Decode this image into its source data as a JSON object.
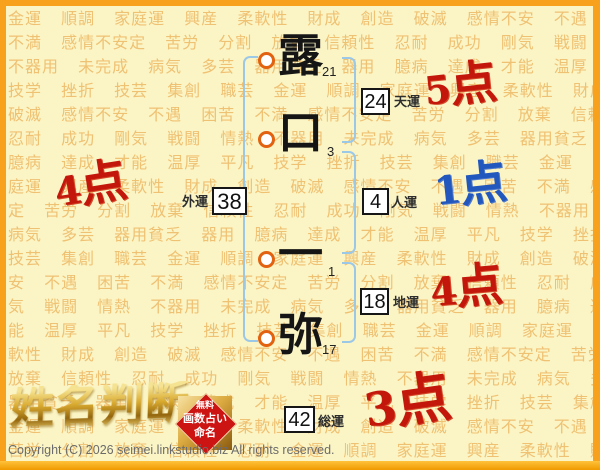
{
  "background": {
    "rows": [
      "金運 順調 家庭運 興産 柔軟性 財成 創造 破滅 感情不安 不遇 困苦",
      "不満 感情不安定 苦労 分割 放棄 信頼性 忍耐 成功 剛気 戦闘 情熱",
      "不器用 未完成 病気 多芸 器用貧乏 器用 臆病 達成 才能 温厚 平凡",
      "技学 挫折 技芸 集創 職芸 金運 順調 家庭運 興産 柔軟性 財成 創造",
      "破滅 感情不安 不遇 困苦 不満 感情不安定 苦労 分割 放棄 信頼性",
      "忍耐 成功 剛気 戦闘 情熱 不器用 未完成 病気 多芸 器用貧乏 器用",
      "臆病 達成 才能 温厚 平凡 技学 挫折 技芸 集創 職芸 金運",
      "庭運 興産 柔軟性 財成 創造 破滅 感情不安 不遇 困苦 不満 感情",
      "定 苦労 分割 放棄 信頼性 忍耐 成功 剛気 戦闘 情熱 不器用",
      "病気 多芸 器用貧乏 器用 臆病 達成 才能 温厚 平凡 技学 挫折",
      "技芸 集創 職芸 金運 順調 家庭運 興産 柔軟性 財成 創造 破滅",
      "安 不遇 困苦 不満 感情不安定 苦労 分割 放棄 信頼性 忍耐 成功",
      "気 戦闘 情熱 不器用 未完成 病気 多芸 器用貧乏 器用 臆病 達成",
      "能 温厚 平凡 技学 挫折 技芸 集創 職芸 金運 順調 家庭運",
      "軟性 財成 創造 破滅 感情不安 不遇 困苦 不満 感情不安定 苦労",
      "放棄 信頼性 忍耐 成功 剛気 戦闘 情熱 不器用 未完成 病気 多芸",
      "器用貧乏 器用 臆病 達成 才能 温厚 平凡 技学 挫折 技芸 集創",
      "金運 順調 家庭運 画数 柔軟性 財成 創造 破滅 感情不安 不遇",
      "苦労 分割 放棄 信頼性 忍耐 金運 順調 家庭運 興産 柔軟性 財成"
    ]
  },
  "name": {
    "characters": [
      {
        "char": "露",
        "strokes": "21"
      },
      {
        "char": "口",
        "strokes": "3"
      },
      {
        "char": "一",
        "strokes": "1"
      },
      {
        "char": "弥",
        "strokes": "17"
      }
    ]
  },
  "fortunes": {
    "tenun": {
      "label": "天運",
      "value": "24",
      "score": "5点"
    },
    "jinun": {
      "label": "人運",
      "value": "4",
      "score": "1点"
    },
    "chiun": {
      "label": "地運",
      "value": "18",
      "score": "4点"
    },
    "gaiun": {
      "label": "外運",
      "value": "38",
      "score": "4点"
    },
    "souun": {
      "label": "総運",
      "value": "42",
      "score": "3点"
    }
  },
  "footer": {
    "logo": "姓名判断",
    "badge": {
      "line1": "無料",
      "line2": "画数占い",
      "line3": "命名"
    },
    "copyright": "Copyright (C) 2026 seimei.linkstudio.biz All rights reserved."
  },
  "colors": {
    "frame_orange": "#f7a11d",
    "background_yellow": "#fbf5c5",
    "pattern_text": "#efc173",
    "bracket_blue": "#9cc8e8",
    "circle_ring_orange": "#e2620f",
    "score_red": "#c3170b",
    "score_blue": "#2257be",
    "badge_red": "#cc1512",
    "logo_gold": "#d8a92e"
  }
}
